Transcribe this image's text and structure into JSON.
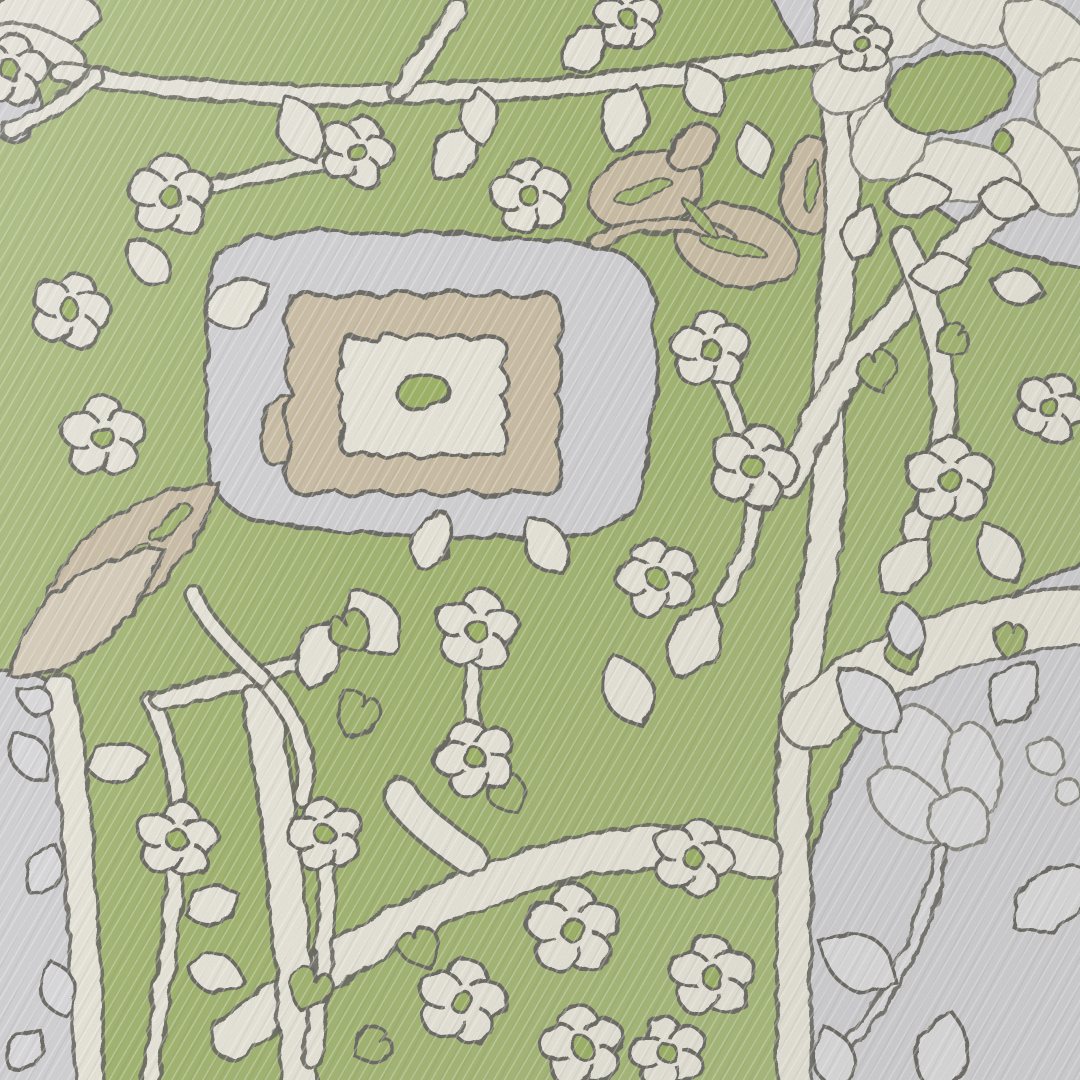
{
  "meta": {
    "description": "Angled close-up photograph of a woven jacquard rug: green field with ivory floral vine lattice, central stepped scalloped medallion (grey, tan, ivory, green dot), tan oak-leaf and plume motifs, and grey corner panels bearing ivory flower outlines.",
    "width": 1080,
    "height": 1080
  },
  "palette": {
    "green_a": "#abbf7c",
    "green_b": "#a0b56a",
    "green_center": "#9cb45f",
    "cream": "#edeadf",
    "cream_dim": "#e6e2d4",
    "gray": "#d5d4d8",
    "gray_flora": "#e2e1e4",
    "gray_leaf": "#dedde1",
    "tan": "#cdbfa5",
    "tan_light": "#dacfbb",
    "outline": "#63625b",
    "outline_soft": "#83827a"
  },
  "scene": {
    "regions": [
      {
        "name": "gray-panel-top-right",
        "path": "M 768,-10 L 1090,-10 L 1090,268 C 1030,262 986,244 944,214 C 898,180 846,120 808,62 C 792,38 778,14 768,-10 Z",
        "fill": "gray"
      },
      {
        "name": "gray-panel-bottom-right",
        "path": "M 1090,560 C 1024,582 962,620 920,662 C 872,706 842,762 822,822 C 802,882 796,962 799,1090 L 1090,1090 Z",
        "fill": "gray"
      },
      {
        "name": "gray-strip-bottom-left",
        "path": "M -10,672 C 28,666 52,678 60,696 C 74,790 82,920 88,1090 L -10,1090 Z",
        "fill": "gray"
      },
      {
        "name": "medallion-panel",
        "path": "M 212,266 C 202,300 210,336 206,372 C 202,410 212,444 208,478 C 224,512 256,528 292,524 C 330,536 372,530 410,536 C 450,542 492,534 530,538 C 570,542 610,530 634,508 C 652,476 644,440 654,406 C 662,372 650,336 656,302 C 648,268 622,244 588,246 C 550,234 508,242 470,234 C 432,228 392,238 354,232 C 316,228 276,236 246,240 C 226,246 216,254 212,266 Z",
        "fill": "gray"
      }
    ],
    "corner_blobs": [
      {
        "name": "cream-corner-blob",
        "cx": 36,
        "cy": 22,
        "rx": 64,
        "ry": 30,
        "rot": -8,
        "fill": "cream"
      },
      {
        "name": "gray-corner-blob",
        "cx": 14,
        "cy": 104,
        "rx": 26,
        "ry": 38,
        "rot": 0,
        "fill": "gray"
      }
    ],
    "bands": [
      {
        "path": "M 836,-20 C 828,60 846,140 842,220 C 838,300 824,380 828,460 C 832,520 818,580 806,650 C 794,730 790,800 793,880 C 796,960 792,1020 794,1090",
        "width": 30
      },
      {
        "path": "M 1090,130 C 1010,200 938,262 886,322 C 848,366 814,420 788,482",
        "width": 26
      },
      {
        "path": "M 902,238 C 928,300 948,360 944,428 C 940,470 928,502 914,532",
        "width": 20
      },
      {
        "path": "M 232,1038 C 320,968 420,906 512,876 C 592,850 682,834 762,858",
        "width": 38
      },
      {
        "path": "M 60,688 C 76,780 84,900 90,1090",
        "width": 26
      },
      {
        "path": "M 260,694 C 276,790 292,900 300,1090",
        "width": 32
      },
      {
        "path": "M -20,42 C 20,32 52,42 72,62",
        "width": 24
      },
      {
        "path": "M 810,720 C 880,660 960,625 1090,615",
        "width": 55
      }
    ],
    "stems": [
      {
        "path": "M 60,72 C 150,88 260,98 380,94 C 470,90 540,92 630,80 C 710,70 770,62 835,52",
        "width": 16
      },
      {
        "path": "M 398,92 C 420,62 440,36 458,8",
        "width": 14
      },
      {
        "path": "M 170,196 C 230,182 300,168 355,154",
        "width": 11
      },
      {
        "path": "M 753,470 C 760,520 748,560 722,598",
        "width": 12
      },
      {
        "path": "M 150,1080 C 160,1000 174,920 178,848 C 181,792 172,742 152,702",
        "width": 13
      },
      {
        "path": "M 325,838 C 332,900 322,980 312,1060",
        "width": 13
      },
      {
        "path": "M 160,700 C 228,686 282,672 342,642",
        "width": 14
      },
      {
        "path": "M 262,678 C 300,720 312,758 302,798",
        "width": 13
      },
      {
        "path": "M 262,678 C 224,642 202,616 192,592",
        "width": 12
      },
      {
        "path": "M 477,632 C 470,680 472,720 475,756",
        "width": 11
      },
      {
        "path": "M 10,130 C 40,120 70,100 95,75",
        "width": 12
      },
      {
        "path": "M 710,352 C 730,400 740,430 752,465",
        "width": 11
      },
      {
        "path": "M 470,858 C 430,830 410,812 400,795",
        "width": 30
      }
    ],
    "flowers": [
      [
        10,
        70,
        34,
        10
      ],
      [
        170,
        196,
        38,
        0
      ],
      [
        357,
        152,
        33,
        20
      ],
      [
        530,
        196,
        35,
        -10
      ],
      [
        70,
        310,
        36,
        15
      ],
      [
        103,
        437,
        38,
        0
      ],
      [
        710,
        350,
        36,
        0
      ],
      [
        753,
        467,
        40,
        18
      ],
      [
        657,
        578,
        36,
        -15
      ],
      [
        950,
        480,
        40,
        0
      ],
      [
        1050,
        408,
        33,
        25
      ],
      [
        477,
        630,
        38,
        10
      ],
      [
        475,
        758,
        36,
        -20
      ],
      [
        573,
        930,
        42,
        0
      ],
      [
        462,
        1002,
        40,
        12
      ],
      [
        582,
        1047,
        38,
        -8
      ],
      [
        693,
        858,
        36,
        20
      ],
      [
        712,
        977,
        38,
        0
      ],
      [
        668,
        1053,
        34,
        -15
      ],
      [
        177,
        840,
        36,
        8
      ],
      [
        325,
        835,
        34,
        -12
      ],
      [
        628,
        18,
        30,
        0
      ]
    ],
    "leaves": [
      [
        300,
        128,
        72,
        30,
        -25
      ],
      [
        455,
        152,
        66,
        28,
        35
      ],
      [
        480,
        116,
        58,
        26,
        -5
      ],
      [
        625,
        118,
        70,
        30,
        18
      ],
      [
        703,
        90,
        58,
        26,
        -32
      ],
      [
        238,
        302,
        70,
        30,
        62
      ],
      [
        148,
        262,
        58,
        24,
        -42
      ],
      [
        695,
        640,
        82,
        34,
        28
      ],
      [
        628,
        690,
        76,
        32,
        -22
      ],
      [
        372,
        622,
        80,
        34,
        -35
      ],
      [
        318,
        655,
        70,
        30,
        15
      ],
      [
        118,
        762,
        64,
        28,
        80
      ],
      [
        213,
        905,
        58,
        26,
        72
      ],
      [
        216,
        973,
        58,
        26,
        104
      ],
      [
        905,
        565,
        70,
        30,
        42
      ],
      [
        1000,
        553,
        66,
        28,
        -28
      ],
      [
        862,
        232,
        56,
        24,
        22
      ],
      [
        545,
        545,
        66,
        28,
        -32
      ],
      [
        432,
        540,
        62,
        26,
        24
      ],
      [
        940,
        272,
        58,
        25,
        78
      ],
      [
        1018,
        287,
        54,
        23,
        102
      ],
      [
        585,
        48,
        58,
        25,
        42
      ],
      [
        755,
        150,
        54,
        23,
        -15
      ],
      [
        868,
        120,
        56,
        24,
        30
      ]
    ],
    "hearts": [
      [
        350,
        632,
        44,
        -30
      ],
      [
        357,
        715,
        48,
        25
      ],
      [
        878,
        372,
        42,
        -15
      ],
      [
        952,
        340,
        36,
        55
      ],
      [
        310,
        990,
        46,
        20
      ],
      [
        420,
        948,
        42,
        -25
      ],
      [
        372,
        1046,
        40,
        60
      ],
      [
        508,
        795,
        40,
        -30
      ],
      [
        905,
        655,
        40,
        -20
      ],
      [
        1010,
        640,
        36,
        15
      ]
    ],
    "tan_leaves": [
      {
        "cx": 646,
        "cy": 190,
        "rx": 58,
        "ry": 38,
        "rot": -18
      },
      {
        "cx": 737,
        "cy": 246,
        "rx": 62,
        "ry": 40,
        "rot": 14
      },
      {
        "cx": 693,
        "cy": 148,
        "rx": 28,
        "ry": 19,
        "rot": -40
      },
      {
        "cx": 812,
        "cy": 186,
        "rx": 32,
        "ry": 48,
        "rot": 8
      },
      {
        "cx": 282,
        "cy": 430,
        "rx": 20,
        "ry": 36,
        "rot": 15
      }
    ],
    "tan_slashes": [
      [
        643,
        191,
        30,
        8,
        -18
      ],
      [
        733,
        247,
        34,
        8,
        14
      ],
      [
        700,
        218,
        24,
        6,
        48
      ],
      [
        812,
        186,
        6,
        26,
        8
      ]
    ],
    "tan_stem": {
      "path": "M 596,242 C 640,222 686,217 728,238",
      "width": 9
    },
    "plume": {
      "blades": [
        {
          "x": 128,
          "y": 558,
          "rot": 50,
          "len": 235,
          "wid": 56,
          "fill": "tan"
        },
        {
          "x": 86,
          "y": 612,
          "rot": 50,
          "len": 200,
          "wid": 46,
          "fill": "tan_light"
        }
      ],
      "slashes": [
        [
          0,
          -55,
          8,
          26
        ],
        [
          4,
          5,
          9,
          30
        ],
        [
          -2,
          62,
          8,
          24
        ]
      ]
    },
    "medallion": {
      "outer_rect": [
        292,
        298,
        556,
        490
      ],
      "outer_bumps": 6,
      "outer_amp": 14,
      "inner_rect": [
        344,
        340,
        502,
        452
      ],
      "inner_bumps": 5,
      "inner_amp": 11,
      "center": [
        423,
        392,
        26,
        17,
        -8
      ]
    },
    "peony": {
      "petals": [
        [
          898,
          22,
          54,
          34,
          -25
        ],
        [
          978,
          14,
          58,
          32,
          8
        ],
        [
          1048,
          40,
          52,
          34,
          38
        ],
        [
          1075,
          105,
          44,
          40,
          80
        ],
        [
          1040,
          168,
          54,
          30,
          55
        ],
        [
          962,
          172,
          58,
          30,
          8
        ],
        [
          890,
          140,
          46,
          34,
          -55
        ],
        [
          852,
          80,
          42,
          30,
          -28
        ]
      ],
      "green_patch": [
        950,
        92,
        64,
        40,
        -12
      ],
      "green_dot": [
        1002,
        142,
        11
      ],
      "leaves": [
        [
          918,
          196,
          66,
          28,
          78
        ],
        [
          1008,
          200,
          60,
          26,
          100
        ]
      ],
      "small_flower": [
        862,
        44,
        27,
        0
      ]
    },
    "tulip": {
      "x": 945,
      "y": 795,
      "rot": -28,
      "petals": [
        [
          0,
          -42,
          36,
          56,
          0
        ],
        [
          -36,
          -8,
          28,
          48,
          -22
        ],
        [
          36,
          -8,
          28,
          48,
          22
        ]
      ],
      "base": [
        0,
        28,
        30
      ],
      "stem": {
        "path": "M 942,850 C 932,900 915,950 886,995 C 870,1020 850,1045 830,1062",
        "width": 8
      },
      "leaves": [
        [
          868,
          700,
          84,
          34,
          -42
        ],
        [
          1014,
          692,
          72,
          30,
          32
        ],
        [
          1052,
          898,
          96,
          38,
          52
        ],
        [
          858,
          962,
          86,
          36,
          -62
        ],
        [
          942,
          1052,
          82,
          34,
          14
        ],
        [
          834,
          1058,
          66,
          28,
          -18
        ],
        [
          906,
          630,
          58,
          24,
          -10
        ]
      ],
      "berries": [
        [
          1046,
          756,
          17
        ],
        [
          1068,
          792,
          13
        ]
      ]
    },
    "gray_strip_leaves": [
      [
        30,
        756,
        58,
        24,
        -36
      ],
      [
        44,
        870,
        54,
        22,
        28
      ],
      [
        58,
        988,
        58,
        24,
        -16
      ],
      [
        26,
        1050,
        48,
        20,
        42
      ],
      [
        36,
        700,
        40,
        18,
        -60
      ]
    ]
  }
}
